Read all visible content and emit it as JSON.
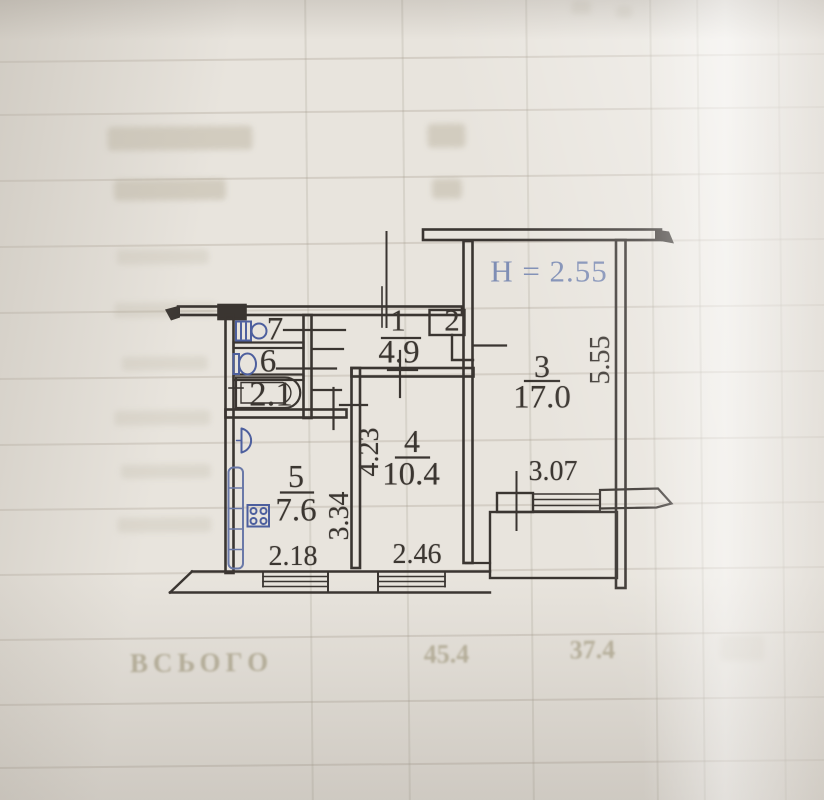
{
  "plan": {
    "height_note": "H = 2.55",
    "rooms": {
      "hall": {
        "number": "1",
        "area": "4.9"
      },
      "closet": {
        "number": "2"
      },
      "living": {
        "number": "3",
        "area": "17.0"
      },
      "bedroom": {
        "number": "4",
        "area": "10.4"
      },
      "kitchen": {
        "number": "5",
        "area": "7.6"
      },
      "wc": {
        "number": "6"
      },
      "washroom": {
        "number": "7"
      },
      "bathroom": {
        "area": "2.1"
      }
    },
    "dimensions": {
      "kitchen_width": "2.18",
      "kitchen_depth": "3.34",
      "bedroom_width": "2.46",
      "bedroom_depth": "4.23",
      "living_window_width": "3.07",
      "living_depth": "5.55"
    },
    "fixtures": [
      "washbasin-icon",
      "toilet-icon",
      "bathtub-icon",
      "kitchen-sink-icon",
      "stove-icon",
      "radiator-icon"
    ]
  },
  "ghost_table": {
    "total_label": "ВСЬОГО",
    "total_value_1": "45.4",
    "total_value_2": "37.4"
  },
  "colors": {
    "ink": "#3a3531",
    "fixture_blue": "#4d5f9e",
    "height_note_color": "#7e8db4",
    "paper": "#e8e4dd"
  }
}
